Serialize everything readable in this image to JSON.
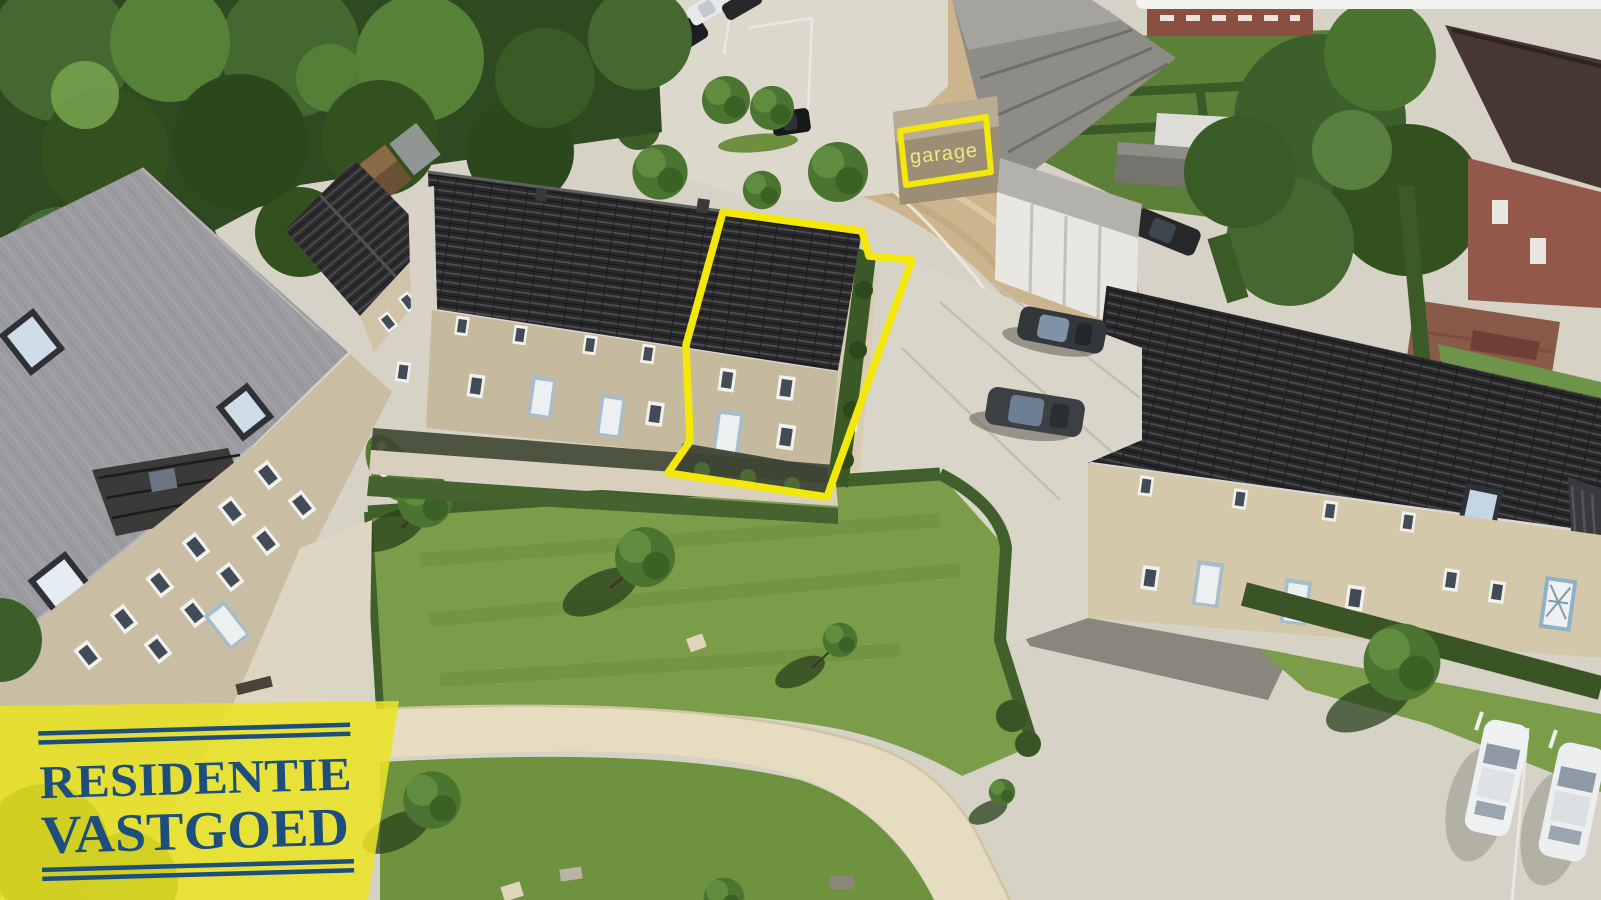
{
  "scene": {
    "type": "aerial-drone-photograph",
    "description": "Aerial drone view of a residential development with terraced houses, lawns, parking areas and cars; the listed corner house and its garage are outlined in yellow.",
    "garage_label": "garage"
  },
  "logo": {
    "line1": "RESIDENTIE",
    "line2": "VASTGOED"
  },
  "colors": {
    "accent_yellow": "#f4e80a",
    "logo_yellow": "#e9e324",
    "logo_blue": "#1d4e7d",
    "garage_label_text": "#f0e87f"
  }
}
